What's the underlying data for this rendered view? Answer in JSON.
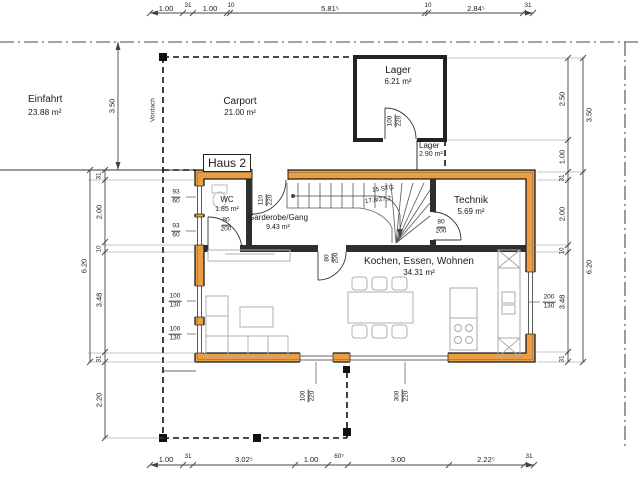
{
  "meta": {
    "drawing_title": "Haus 2"
  },
  "rooms": {
    "einfahrt": {
      "name": "Einfahrt",
      "area": "23.88 m²"
    },
    "carport": {
      "name": "Carport",
      "area": "21.00 m²"
    },
    "lager": {
      "name": "Lager",
      "area": "6.21 m²"
    },
    "lager2": {
      "name": "Lager",
      "area": "2.90 m²"
    },
    "wc": {
      "name": "WC",
      "area": "1.85 m²"
    },
    "gang": {
      "name": "Garderobe/Gang",
      "area": "9.43 m²"
    },
    "technik": {
      "name": "Technik",
      "area": "5.69 m²"
    },
    "wohnen": {
      "name": "Kochen, Essen, Wohnen",
      "area": "34.31 m²"
    }
  },
  "annotations": {
    "vordach": "Vordach",
    "stairs_line1": "15 STG",
    "stairs_line2": "17,8/27,2"
  },
  "openings": {
    "lager_door": {
      "t": "100",
      "b": "220"
    },
    "entrance": {
      "t": "110",
      "b": "220"
    },
    "wc_door": {
      "t": "80",
      "b": "200"
    },
    "technik_door": {
      "t": "80",
      "b": "200"
    },
    "living_door": {
      "t": "80",
      "b": "200"
    },
    "wc_win1": {
      "t": "93",
      "b": "60"
    },
    "wc_win2": {
      "t": "93",
      "b": "60"
    },
    "liv_win1": {
      "t": "100",
      "b": "130"
    },
    "liv_win2": {
      "t": "100",
      "b": "130"
    },
    "kitchen_win": {
      "t": "200",
      "b": "130"
    },
    "terr_door": {
      "t": "100",
      "b": "220"
    },
    "terr_win": {
      "t": "300",
      "b": "220"
    }
  },
  "dims": {
    "top": [
      "1.00",
      "31",
      "1.00",
      "10",
      "5.81⁵",
      "10",
      "2.84⁵",
      "31"
    ],
    "bottom": [
      "1.00",
      "31",
      "3.02⁵",
      "1.00",
      "60⁵",
      "3.00",
      "2.22⁵",
      "31"
    ],
    "left": [
      "31",
      "2.00",
      "10",
      "3.48",
      "31"
    ],
    "left_total": "6.20",
    "left_lower": "2.20",
    "left_upper": "3.50",
    "right": [
      "2.50",
      "1.00",
      "31",
      "2.00",
      "10",
      "3.48",
      "31"
    ],
    "right_outer": [
      "3.50",
      "6.20"
    ]
  },
  "colors": {
    "wall": "#EA9E43",
    "wall_edge": "#1a1a1a"
  }
}
